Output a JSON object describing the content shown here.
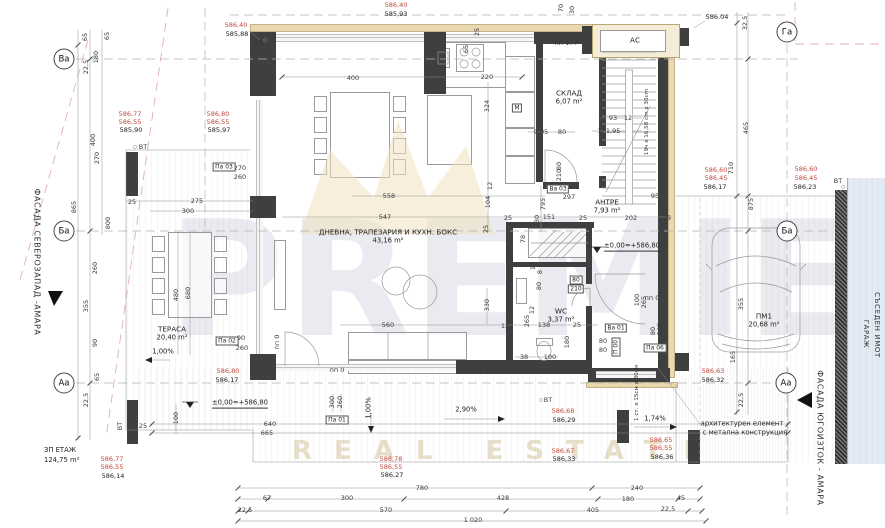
{
  "watermark": {
    "line1": "PREMIER",
    "line2": "REAL ESTATE"
  },
  "facade_left": "ФАСАДА СЕВЕРОЗАПАД -АМАРА",
  "facade_right": "ФАСАДА ЮГОИЗТОК - АМАРА",
  "neighbor_labels": {
    "garage": "ГАРАЖ",
    "plot": "СЪСЕДЕН ИМОТ"
  },
  "floor_summary": {
    "label": "ЗП ЕТАЖ",
    "area": "124,75 m²"
  },
  "axis_bubbles": [
    {
      "id": "Ва",
      "x": 64,
      "y": 59
    },
    {
      "id": "Ба",
      "x": 64,
      "y": 231
    },
    {
      "id": "Аа",
      "x": 64,
      "y": 383
    },
    {
      "id": "Га",
      "x": 787,
      "y": 32
    },
    {
      "id": "Ба",
      "x": 787,
      "y": 231
    },
    {
      "id": "Аа",
      "x": 786,
      "y": 383
    }
  ],
  "rooms": [
    {
      "name": "ДНЕВНА, ТРАПЕЗАРИЯ И КУХН. БОКС",
      "area": "43,16 m²",
      "x": 388,
      "y": 236
    },
    {
      "name": "СКЛАД",
      "area": "6,07 m²",
      "x": 569,
      "y": 97
    },
    {
      "name": "АНТРЕ",
      "area": "7,93 m²",
      "x": 607,
      "y": 206
    },
    {
      "name": "WC",
      "area": "3,37 m²",
      "x": 561,
      "y": 315
    },
    {
      "name": "ТЕРАСА",
      "area": "20,40 m²",
      "x": 172,
      "y": 333
    },
    {
      "name": "ПМ1",
      "area": "20,68 m²",
      "x": 764,
      "y": 320
    },
    {
      "name": "АС",
      "area": "",
      "x": 635,
      "y": 40
    }
  ],
  "labels": [
    {
      "t": "400",
      "x": 353,
      "y": 78
    },
    {
      "t": "220",
      "x": 487,
      "y": 77
    },
    {
      "t": "324",
      "x": 487,
      "y": 106,
      "r": 1
    },
    {
      "t": "65",
      "x": 466,
      "y": 49,
      "r": 1
    },
    {
      "t": "25",
      "x": 477,
      "y": 32,
      "r": 1
    },
    {
      "t": "70",
      "x": 561,
      "y": 8,
      "r": 1
    },
    {
      "t": "30",
      "x": 572,
      "y": 10,
      "r": 1
    },
    {
      "t": "9,05",
      "x": 541,
      "y": 132
    },
    {
      "t": "80",
      "x": 562,
      "y": 132
    },
    {
      "t": "93",
      "x": 613,
      "y": 118
    },
    {
      "t": "12",
      "x": 628,
      "y": 118
    },
    {
      "t": "121,95",
      "x": 609,
      "y": 131
    },
    {
      "t": "32,5",
      "x": 745,
      "y": 23,
      "r": 1
    },
    {
      "t": "465",
      "x": 746,
      "y": 128,
      "r": 1
    },
    {
      "t": "710",
      "x": 731,
      "y": 168,
      "r": 1
    },
    {
      "t": "875",
      "x": 751,
      "y": 204,
      "r": 1
    },
    {
      "t": "355",
      "x": 741,
      "y": 304,
      "r": 1
    },
    {
      "t": "165",
      "x": 733,
      "y": 357,
      "r": 1
    },
    {
      "t": "22,5",
      "x": 741,
      "y": 400,
      "r": 1
    },
    {
      "t": "65",
      "x": 85,
      "y": 37,
      "r": 1
    },
    {
      "t": "65",
      "x": 107,
      "y": 36,
      "r": 1
    },
    {
      "t": "180",
      "x": 96,
      "y": 57,
      "r": 1
    },
    {
      "t": "22,5",
      "x": 86,
      "y": 67,
      "r": 1
    },
    {
      "t": "400",
      "x": 93,
      "y": 140,
      "r": 1
    },
    {
      "t": "270",
      "x": 97,
      "y": 158,
      "r": 1
    },
    {
      "t": "865",
      "x": 74,
      "y": 207,
      "r": 1
    },
    {
      "t": "800",
      "x": 108,
      "y": 223,
      "r": 1
    },
    {
      "t": "260",
      "x": 95,
      "y": 268,
      "r": 1
    },
    {
      "t": "355",
      "x": 86,
      "y": 306,
      "r": 1
    },
    {
      "t": "90",
      "x": 95,
      "y": 343,
      "r": 1
    },
    {
      "t": "65",
      "x": 97,
      "y": 377,
      "r": 1
    },
    {
      "t": "22,5",
      "x": 86,
      "y": 400,
      "r": 1
    },
    {
      "t": "25",
      "x": 132,
      "y": 202
    },
    {
      "t": "275",
      "x": 197,
      "y": 201
    },
    {
      "t": "300",
      "x": 188,
      "y": 211
    },
    {
      "t": "480",
      "x": 176,
      "y": 295,
      "r": 1
    },
    {
      "t": "680",
      "x": 188,
      "y": 293,
      "r": 1
    },
    {
      "t": "270",
      "x": 240,
      "y": 168
    },
    {
      "t": "260",
      "x": 240,
      "y": 177
    },
    {
      "t": "90",
      "x": 241,
      "y": 338
    },
    {
      "t": "260",
      "x": 242,
      "y": 348
    },
    {
      "t": "25",
      "x": 143,
      "y": 426
    },
    {
      "t": "100",
      "x": 176,
      "y": 418,
      "r": 1
    },
    {
      "t": "640",
      "x": 270,
      "y": 424
    },
    {
      "t": "665",
      "x": 267,
      "y": 433
    },
    {
      "t": "558",
      "x": 389,
      "y": 196
    },
    {
      "t": "547",
      "x": 385,
      "y": 217
    },
    {
      "t": "795",
      "x": 543,
      "y": 204,
      "r": 1
    },
    {
      "t": "730",
      "x": 537,
      "y": 221,
      "r": 1
    },
    {
      "t": "104",
      "x": 488,
      "y": 202,
      "r": 1
    },
    {
      "t": "12",
      "x": 490,
      "y": 186,
      "r": 1
    },
    {
      "t": "25",
      "x": 486,
      "y": 229,
      "r": 1
    },
    {
      "t": "25",
      "x": 508,
      "y": 218
    },
    {
      "t": "151",
      "x": 549,
      "y": 217
    },
    {
      "t": "25",
      "x": 583,
      "y": 218
    },
    {
      "t": "297",
      "x": 569,
      "y": 197
    },
    {
      "t": "95",
      "x": 655,
      "y": 196
    },
    {
      "t": "202",
      "x": 631,
      "y": 218
    },
    {
      "t": "25",
      "x": 667,
      "y": 218
    },
    {
      "t": "78",
      "x": 523,
      "y": 239,
      "r": 1
    },
    {
      "t": "12",
      "x": 533,
      "y": 266,
      "r": 1
    },
    {
      "t": "8",
      "x": 540,
      "y": 272,
      "r": 1
    },
    {
      "t": "80",
      "x": 539,
      "y": 286,
      "r": 1
    },
    {
      "t": "12",
      "x": 532,
      "y": 310,
      "r": 1
    },
    {
      "t": "265",
      "x": 527,
      "y": 321,
      "r": 1
    },
    {
      "t": "138",
      "x": 544,
      "y": 325
    },
    {
      "t": "25",
      "x": 577,
      "y": 325
    },
    {
      "t": "295",
      "x": 665,
      "y": 241,
      "r": 1
    },
    {
      "t": "100",
      "x": 637,
      "y": 300,
      "r": 1
    },
    {
      "t": "265",
      "x": 644,
      "y": 302,
      "r": 1
    },
    {
      "t": "180",
      "x": 567,
      "y": 342,
      "r": 1
    },
    {
      "t": "100",
      "x": 550,
      "y": 357
    },
    {
      "t": "38",
      "x": 524,
      "y": 357
    },
    {
      "t": "560",
      "x": 388,
      "y": 325
    },
    {
      "t": "330",
      "x": 487,
      "y": 305,
      "r": 1
    },
    {
      "t": "12",
      "x": 505,
      "y": 326
    },
    {
      "t": "25",
      "x": 479,
      "y": 368,
      "r": 1
    },
    {
      "t": "300",
      "x": 332,
      "y": 402,
      "r": 1
    },
    {
      "t": "260",
      "x": 340,
      "y": 402,
      "r": 1
    },
    {
      "t": "80",
      "x": 603,
      "y": 341
    },
    {
      "t": "80",
      "x": 603,
      "y": 350
    },
    {
      "t": "80",
      "x": 653,
      "y": 331,
      "r": 1
    },
    {
      "t": "265",
      "x": 660,
      "y": 329,
      "r": 1
    },
    {
      "t": "80",
      "x": 559,
      "y": 166,
      "r": 1
    },
    {
      "t": "210",
      "x": 559,
      "y": 175,
      "r": 1
    },
    {
      "t": "780",
      "x": 422,
      "y": 488
    },
    {
      "t": "240",
      "x": 637,
      "y": 488
    },
    {
      "t": "67",
      "x": 267,
      "y": 498
    },
    {
      "t": "300",
      "x": 347,
      "y": 498
    },
    {
      "t": "428",
      "x": 503,
      "y": 498
    },
    {
      "t": "180",
      "x": 628,
      "y": 499
    },
    {
      "t": "45",
      "x": 681,
      "y": 498
    },
    {
      "t": "22,5",
      "x": 245,
      "y": 510
    },
    {
      "t": "570",
      "x": 386,
      "y": 510
    },
    {
      "t": "405",
      "x": 593,
      "y": 510
    },
    {
      "t": "22,5",
      "x": 668,
      "y": 509
    },
    {
      "t": "1 020",
      "x": 473,
      "y": 520
    },
    {
      "t": "586,40",
      "x": 236,
      "y": 25,
      "c": "red"
    },
    {
      "t": "585,88",
      "x": 237,
      "y": 34,
      "c": "blk"
    },
    {
      "t": "586,40",
      "x": 396,
      "y": 5,
      "c": "red"
    },
    {
      "t": "585,93",
      "x": 396,
      "y": 14,
      "c": "blk"
    },
    {
      "t": "586,77",
      "x": 130,
      "y": 114,
      "c": "red"
    },
    {
      "t": "586,55",
      "x": 130,
      "y": 122,
      "c": "red"
    },
    {
      "t": "585,90",
      "x": 131,
      "y": 130,
      "c": "blk"
    },
    {
      "t": "586,80",
      "x": 218,
      "y": 114,
      "c": "red"
    },
    {
      "t": "586,55",
      "x": 218,
      "y": 122,
      "c": "red"
    },
    {
      "t": "585,97",
      "x": 219,
      "y": 130,
      "c": "blk"
    },
    {
      "t": "586,60",
      "x": 716,
      "y": 170,
      "c": "red"
    },
    {
      "t": "586,45",
      "x": 716,
      "y": 178,
      "c": "red"
    },
    {
      "t": "586,17",
      "x": 715,
      "y": 187,
      "c": "blk"
    },
    {
      "t": "586,60",
      "x": 806,
      "y": 169,
      "c": "red"
    },
    {
      "t": "586,45",
      "x": 806,
      "y": 178,
      "c": "red"
    },
    {
      "t": "586,23",
      "x": 805,
      "y": 187,
      "c": "blk"
    },
    {
      "t": "586,80",
      "x": 228,
      "y": 371,
      "c": "red"
    },
    {
      "t": "586,17",
      "x": 227,
      "y": 380,
      "c": "blk"
    },
    {
      "t": "586,77",
      "x": 112,
      "y": 459,
      "c": "red"
    },
    {
      "t": "586,55",
      "x": 112,
      "y": 467,
      "c": "red"
    },
    {
      "t": "586,14",
      "x": 113,
      "y": 476,
      "c": "blk"
    },
    {
      "t": "586,78",
      "x": 391,
      "y": 459,
      "c": "red"
    },
    {
      "t": "586,55",
      "x": 391,
      "y": 467,
      "c": "red"
    },
    {
      "t": "586,27",
      "x": 392,
      "y": 475,
      "c": "blk"
    },
    {
      "t": "586,68",
      "x": 563,
      "y": 411,
      "c": "red"
    },
    {
      "t": "586,29",
      "x": 564,
      "y": 420,
      "c": "blk"
    },
    {
      "t": "586,67",
      "x": 563,
      "y": 451,
      "c": "red"
    },
    {
      "t": "586,33",
      "x": 564,
      "y": 459,
      "c": "blk"
    },
    {
      "t": "586,63",
      "x": 713,
      "y": 371,
      "c": "red"
    },
    {
      "t": "586,32",
      "x": 713,
      "y": 380,
      "c": "blk"
    },
    {
      "t": "586,65",
      "x": 661,
      "y": 440,
      "c": "red"
    },
    {
      "t": "586,55",
      "x": 661,
      "y": 448,
      "c": "red"
    },
    {
      "t": "586,36",
      "x": 662,
      "y": 457,
      "c": "blk"
    },
    {
      "t": "586.04",
      "x": 717,
      "y": 17,
      "c": "blk"
    },
    {
      "t": "±0,00=+586,80",
      "x": 632,
      "y": 247,
      "c": "note u"
    },
    {
      "t": "±0,00=+586,80",
      "x": 240,
      "y": 404,
      "c": "note u"
    },
    {
      "t": "архитектурен елемент",
      "x": 742,
      "y": 424,
      "c": "note"
    },
    {
      "t": "с метална конструкция",
      "x": 745,
      "y": 433,
      "c": "note"
    },
    {
      "t": "2,90%",
      "x": 466,
      "y": 410,
      "c": "note"
    },
    {
      "t": "1,74%",
      "x": 655,
      "y": 419,
      "c": "note"
    },
    {
      "t": "1,00%",
      "x": 163,
      "y": 352,
      "c": "note"
    },
    {
      "t": "1,00%",
      "x": 369,
      "y": 408,
      "c": "note",
      "r": 1
    },
    {
      "t": "19ч x 16,58 cm x 30cm",
      "x": 648,
      "y": 122,
      "c": "tiny",
      "r": 1
    },
    {
      "t": "1 ст. x 15см x 30см",
      "x": 638,
      "y": 393,
      "c": "tiny",
      "r": 1
    },
    {
      "t": "пп 177",
      "x": 566,
      "y": 43
    },
    {
      "t": "пп 0",
      "x": 337,
      "y": 370
    },
    {
      "t": "пп 0",
      "x": 277,
      "y": 342,
      "r": 1
    },
    {
      "t": "пп 0",
      "x": 652,
      "y": 298
    },
    {
      "t": "ВТ",
      "x": 258,
      "y": 43
    },
    {
      "t": "ВТ",
      "x": 143,
      "y": 147
    },
    {
      "t": "ВТ",
      "x": 838,
      "y": 181
    },
    {
      "t": "ВТ",
      "x": 548,
      "y": 400
    },
    {
      "t": "ВТ",
      "x": 120,
      "y": 426,
      "r": 1
    },
    {
      "t": "Па 03",
      "x": 224,
      "y": 167,
      "c": "tag"
    },
    {
      "t": "Па 02",
      "x": 227,
      "y": 341,
      "c": "tag"
    },
    {
      "t": "Па 01",
      "x": 337,
      "y": 420,
      "c": "tag"
    },
    {
      "t": "Па 06",
      "x": 655,
      "y": 348,
      "c": "tag"
    },
    {
      "t": "Ва 01",
      "x": 616,
      "y": 328,
      "c": "tag"
    },
    {
      "t": "Ва 03",
      "x": 558,
      "y": 189,
      "c": "tag"
    },
    {
      "t": "П 00",
      "x": 616,
      "y": 347,
      "c": "tag",
      "r": 1
    },
    {
      "t": "80",
      "x": 576,
      "y": 280,
      "c": "tag"
    },
    {
      "t": "210",
      "x": 576,
      "y": 289,
      "c": "tag"
    },
    {
      "t": "М",
      "x": 517,
      "y": 108,
      "c": "tag"
    }
  ]
}
